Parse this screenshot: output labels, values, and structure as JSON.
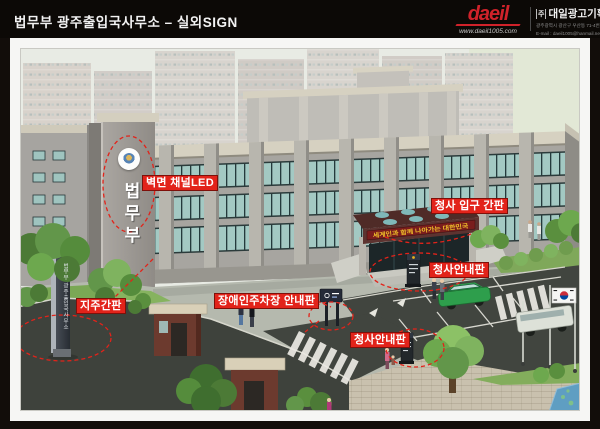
{
  "header": {
    "title": "법무부 광주출입국사무소 – 실외SIGN",
    "logo_text": "daeil",
    "logo_url": "www.daeil1005.com",
    "company_prefix": "주",
    "company_name": "대일광고기획",
    "company_info_line1": "광주광역시 광산구 우산동 71-4번지 / 전 화 : 062-522-1005 / 527-1005",
    "company_info_line2": "E-mail : daeil1005@hanmail.net  webhard : ID-daeil1005 / PW-5221005"
  },
  "annotations": {
    "wall_led": "벽면 채널LED",
    "entrance_sign": "청사 입구 간판",
    "info_sign_right": "청사안내판",
    "disabled_parking": "장애인주차장 안내판",
    "info_sign_bottom": "청사안내판",
    "pylon": "지주간판"
  },
  "scene": {
    "wall_sign_text": "법무부",
    "pylon_text": "법무부 광주출입국사무소",
    "banner_text": "세계인과 함께 나아가는 대한민국"
  },
  "colors": {
    "label_bg": "#e2231a",
    "label_border": "#7e100a",
    "annotation_red": "#e2231a",
    "logo_red": "#d0222a",
    "canopy": "#5d3330",
    "banner_bg": "#7a1d1d",
    "banner_text": "#f0c02a",
    "glass": "#a3c9c3",
    "granite": "#a7a5a0"
  }
}
